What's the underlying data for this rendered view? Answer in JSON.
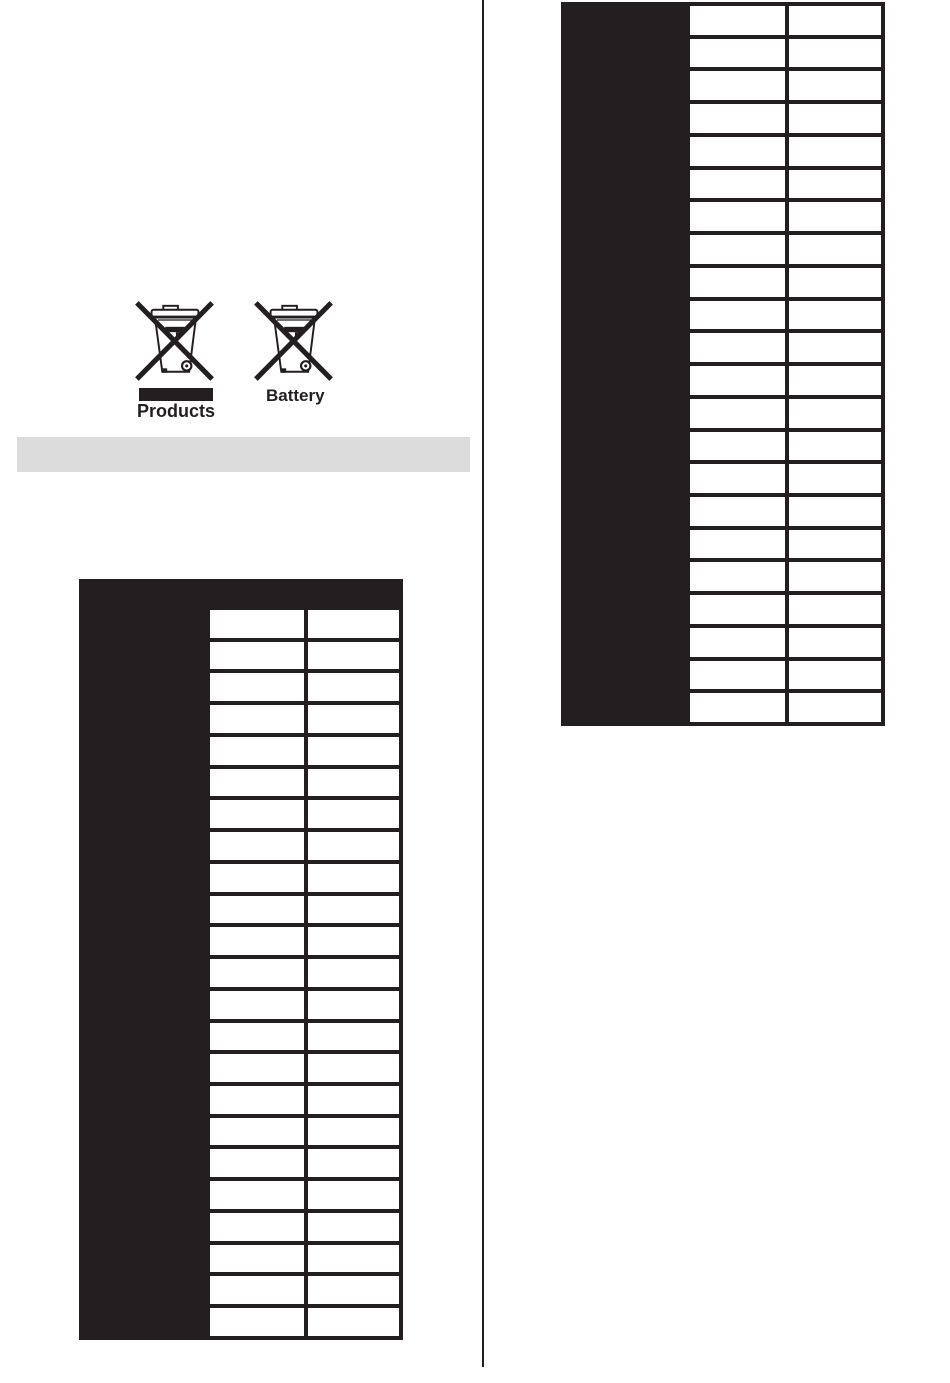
{
  "recycling": {
    "products_label": "Products",
    "battery_label": "Battery",
    "icons": {
      "products": "weee-crossed-out-wheeled-bin",
      "battery": "weee-crossed-out-wheeled-bin"
    }
  },
  "section_bar": {
    "text": ""
  },
  "left_table": {
    "header_text": "",
    "label_column_text": "",
    "rows": [
      [
        "",
        ""
      ],
      [
        "",
        ""
      ],
      [
        "",
        ""
      ],
      [
        "",
        ""
      ],
      [
        "",
        ""
      ],
      [
        "",
        ""
      ],
      [
        "",
        ""
      ],
      [
        "",
        ""
      ],
      [
        "",
        ""
      ],
      [
        "",
        ""
      ],
      [
        "",
        ""
      ],
      [
        "",
        ""
      ],
      [
        "",
        ""
      ],
      [
        "",
        ""
      ],
      [
        "",
        ""
      ],
      [
        "",
        ""
      ],
      [
        "",
        ""
      ],
      [
        "",
        ""
      ],
      [
        "",
        ""
      ],
      [
        "",
        ""
      ],
      [
        "",
        ""
      ],
      [
        "",
        ""
      ],
      [
        "",
        ""
      ]
    ]
  },
  "right_table": {
    "label_column_text": "",
    "rows": [
      [
        "",
        ""
      ],
      [
        "",
        ""
      ],
      [
        "",
        ""
      ],
      [
        "",
        ""
      ],
      [
        "",
        ""
      ],
      [
        "",
        ""
      ],
      [
        "",
        ""
      ],
      [
        "",
        ""
      ],
      [
        "",
        ""
      ],
      [
        "",
        ""
      ],
      [
        "",
        ""
      ],
      [
        "",
        ""
      ],
      [
        "",
        ""
      ],
      [
        "",
        ""
      ],
      [
        "",
        ""
      ],
      [
        "",
        ""
      ],
      [
        "",
        ""
      ],
      [
        "",
        ""
      ],
      [
        "",
        ""
      ],
      [
        "",
        ""
      ],
      [
        "",
        ""
      ],
      [
        "",
        ""
      ]
    ]
  },
  "colors": {
    "ink": "#231f20",
    "section_bar": "#dcdcdc",
    "page": "#ffffff"
  }
}
